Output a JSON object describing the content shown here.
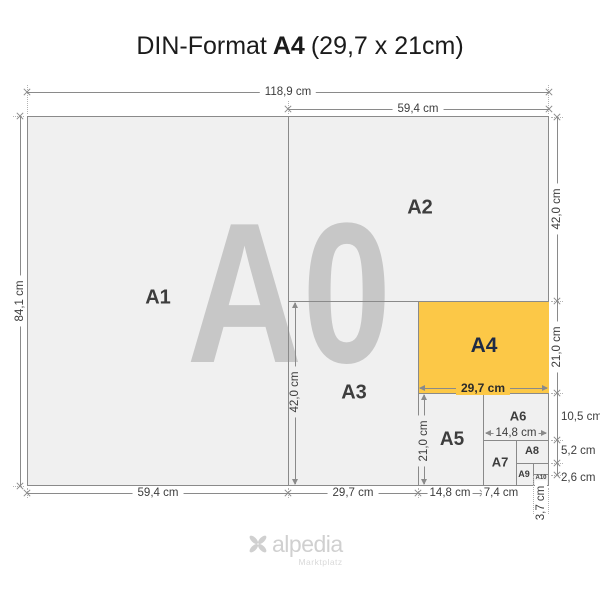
{
  "title": {
    "prefix": "DIN-Format",
    "format": "A4",
    "size": "(29,7 x 21cm)"
  },
  "watermark": "A0",
  "sheets": {
    "a1": "A1",
    "a2": "A2",
    "a3": "A3",
    "a4": "A4",
    "a5": "A5",
    "a6": "A6",
    "a7": "A7",
    "a8": "A8",
    "a9": "A9",
    "a10": "A10"
  },
  "dims": {
    "a0_width": "118,9 cm",
    "a2_width": "59,4 cm",
    "a0_height": "84,1 cm",
    "a2_height": "42,0 cm",
    "a4_height": "21,0 cm",
    "a6_height": "10,5 cm",
    "a8_height": "5,2 cm",
    "a10_height": "2,6 cm",
    "a1_width": "59,4 cm",
    "a3_width": "29,7 cm",
    "a5_width": "14,8 cm",
    "a7_width": "7,4 cm",
    "a10_width": "3,7 cm",
    "a3_height_inner": "42,0 cm",
    "a5_height_inner": "21,0 cm",
    "a4_width_inner": "29,7 cm",
    "a6_width_inner": "14,8 cm"
  },
  "logo": {
    "name": "alpedia",
    "tagline": "Marktplatz"
  },
  "colors": {
    "highlight": "#FCC847",
    "sheet_fill": "#F0F0F0",
    "watermark": "#C7C7C7",
    "label": "#3D3D3D",
    "a4_label": "#1F2B45",
    "dim_line": "#8A8A8A",
    "dim_text": "#3D3D3D",
    "logo": "#D0D0D0",
    "bg": "#FFFFFF"
  }
}
